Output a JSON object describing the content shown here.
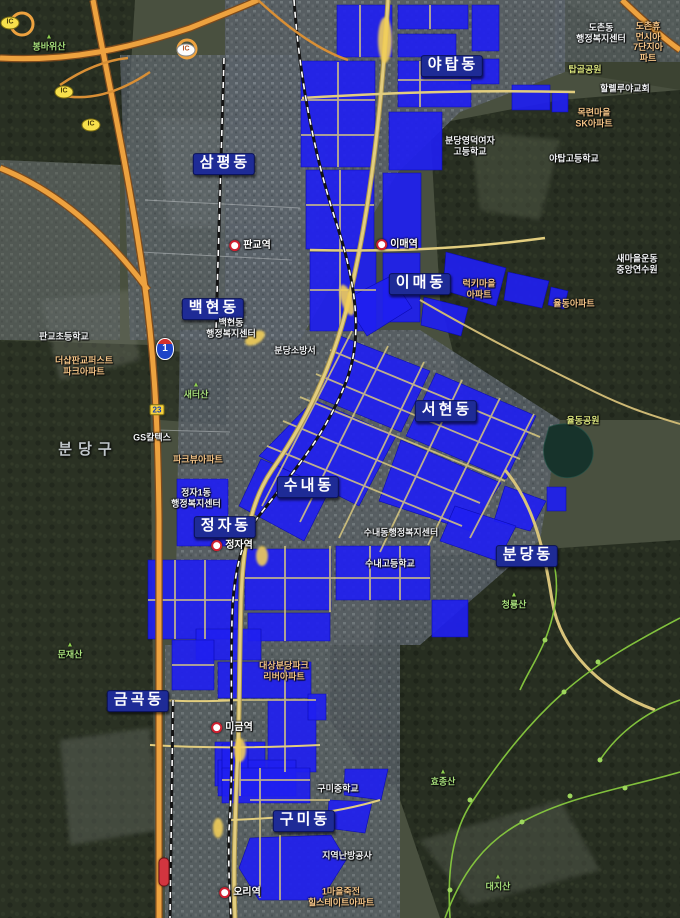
{
  "map": {
    "title": "분당 신도시 위성지도",
    "colors": {
      "highlight_blue": "#1f1ff0",
      "expressway_orange": "#eda23f",
      "street_yellow": "#e2cd7e",
      "railway_black": "#131313",
      "trail_green": "#86c93f",
      "district_badge_navy": "#1e2b96"
    },
    "districts": [
      {
        "label": "야탑동",
        "x": 452,
        "y": 66
      },
      {
        "label": "삼평동",
        "x": 224,
        "y": 164
      },
      {
        "label": "이매동",
        "x": 420,
        "y": 284
      },
      {
        "label": "백현동",
        "x": 213,
        "y": 309
      },
      {
        "label": "서현동",
        "x": 446,
        "y": 411
      },
      {
        "label": "수내동",
        "x": 308,
        "y": 487
      },
      {
        "label": "정자동",
        "x": 225,
        "y": 527
      },
      {
        "label": "분당동",
        "x": 527,
        "y": 556
      },
      {
        "label": "금곡동",
        "x": 138,
        "y": 701
      },
      {
        "label": "구미동",
        "x": 304,
        "y": 821
      }
    ],
    "gu_label": {
      "label": "분당구",
      "x": 88,
      "y": 450
    },
    "stations": [
      {
        "label": "판교역",
        "x": 250,
        "y": 246
      },
      {
        "label": "이매역",
        "x": 397,
        "y": 245
      },
      {
        "label": "정자역",
        "x": 232,
        "y": 546
      },
      {
        "label": "미금역",
        "x": 232,
        "y": 728
      },
      {
        "label": "오리역",
        "x": 240,
        "y": 893
      }
    ],
    "places": [
      {
        "label": "도촌동\n행정복지센터",
        "x": 601,
        "y": 33,
        "kind": "facility"
      },
      {
        "label": "할렐루야교회",
        "x": 625,
        "y": 89,
        "kind": "facility"
      },
      {
        "label": "분당영덕여자\n고등학교",
        "x": 470,
        "y": 146,
        "kind": "facility"
      },
      {
        "label": "야탑고등학교",
        "x": 574,
        "y": 159,
        "kind": "facility"
      },
      {
        "label": "새마을운동\n중앙연수원",
        "x": 637,
        "y": 264,
        "kind": "facility"
      },
      {
        "label": "백현동\n행정복지센터",
        "x": 231,
        "y": 328,
        "kind": "facility"
      },
      {
        "label": "판교초등학교",
        "x": 64,
        "y": 337,
        "kind": "facility"
      },
      {
        "label": "분당소방서",
        "x": 295,
        "y": 351,
        "kind": "facility"
      },
      {
        "label": "GS칼텍스",
        "x": 152,
        "y": 438,
        "kind": "facility"
      },
      {
        "label": "정자1동\n행정복지센터",
        "x": 196,
        "y": 498,
        "kind": "facility"
      },
      {
        "label": "수내동행정복지센터",
        "x": 401,
        "y": 533,
        "kind": "facility"
      },
      {
        "label": "수내고등학교",
        "x": 390,
        "y": 564,
        "kind": "facility"
      },
      {
        "label": "구미중학교",
        "x": 338,
        "y": 789,
        "kind": "facility"
      },
      {
        "label": "지역난방공사",
        "x": 347,
        "y": 856,
        "kind": "facility"
      },
      {
        "label": "도촌휴먼시아\n7단지아파트",
        "x": 648,
        "y": 42,
        "kind": "apartment"
      },
      {
        "label": "목련마을\nSK아파트",
        "x": 594,
        "y": 118,
        "kind": "apartment"
      },
      {
        "label": "럭키마을\n아파트",
        "x": 479,
        "y": 289,
        "kind": "apartment"
      },
      {
        "label": "율동아파트",
        "x": 574,
        "y": 304,
        "kind": "apartment"
      },
      {
        "label": "더샵판교퍼스트\n파크아파트",
        "x": 84,
        "y": 366,
        "kind": "apartment"
      },
      {
        "label": "파크뷰아파트",
        "x": 198,
        "y": 460,
        "kind": "apartment"
      },
      {
        "label": "대상분당파크\n리버아파트",
        "x": 284,
        "y": 671,
        "kind": "apartment"
      },
      {
        "label": "1마을죽전\n힐스테이트아파트",
        "x": 341,
        "y": 897,
        "kind": "apartment"
      },
      {
        "label": "봉바위산",
        "x": 49,
        "y": 43,
        "kind": "mountain"
      },
      {
        "label": "새터산",
        "x": 196,
        "y": 391,
        "kind": "mountain"
      },
      {
        "label": "청룡산",
        "x": 514,
        "y": 601,
        "kind": "mountain"
      },
      {
        "label": "문재산",
        "x": 70,
        "y": 651,
        "kind": "mountain"
      },
      {
        "label": "효종산",
        "x": 443,
        "y": 778,
        "kind": "mountain"
      },
      {
        "label": "대지산",
        "x": 498,
        "y": 883,
        "kind": "mountain"
      },
      {
        "label": "탑골공원",
        "x": 585,
        "y": 70,
        "kind": "park"
      },
      {
        "label": "율동공원",
        "x": 583,
        "y": 421,
        "kind": "park"
      }
    ],
    "road_badges": [
      {
        "label": "IC",
        "style": "yellow",
        "x": 10,
        "y": 23
      },
      {
        "label": "IC",
        "style": "white",
        "x": 186,
        "y": 50
      },
      {
        "label": "IC",
        "style": "yellow",
        "x": 64,
        "y": 92
      },
      {
        "label": "IC",
        "style": "yellow",
        "x": 91,
        "y": 125
      },
      {
        "label": "1",
        "style": "expressway",
        "x": 165,
        "y": 349
      },
      {
        "label": "23",
        "style": "local",
        "x": 157,
        "y": 410
      },
      {
        "label": "",
        "style": "red-capsule",
        "x": 164,
        "y": 872
      }
    ]
  }
}
